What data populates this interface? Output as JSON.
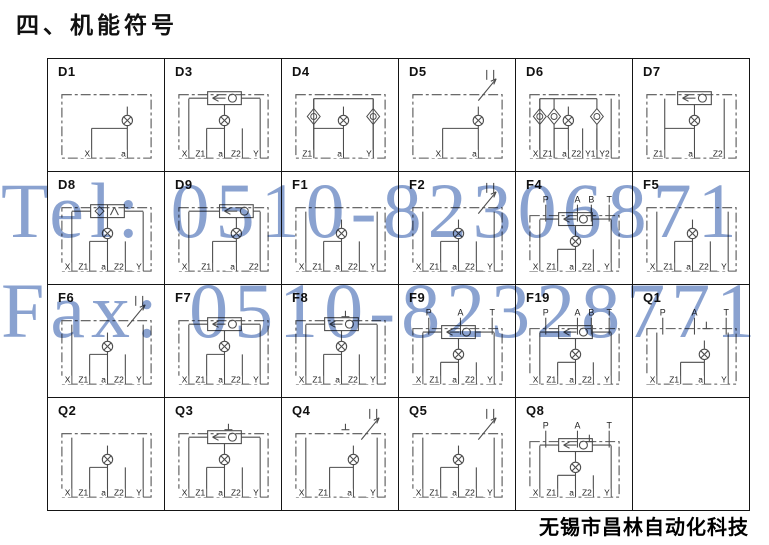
{
  "page": {
    "title": "四、机能符号",
    "company": "无锡市昌林自动化科技"
  },
  "watermark": {
    "line1": "Tel: 0510-82306871",
    "line2": "Fax: 0510-82328771",
    "color": "#8aa2d0"
  },
  "colors": {
    "grid_border": "#151515",
    "schematic_line": "#4d4d4d",
    "label_text": "#222222"
  },
  "table": {
    "columns": 6,
    "rows": 4,
    "cells": [
      {
        "id": "D1",
        "ports": [
          "X",
          "a"
        ],
        "top_ports": [],
        "features": [
          "orifice"
        ]
      },
      {
        "id": "D3",
        "ports": [
          "X",
          "Z1",
          "a",
          "Z2",
          "Y"
        ],
        "top_ports": [],
        "features": [
          "shuttle",
          "orifice"
        ]
      },
      {
        "id": "D4",
        "ports": [
          "Z1",
          "a",
          "Y"
        ],
        "top_ports": [],
        "features": [
          "check2",
          "orifice"
        ]
      },
      {
        "id": "D5",
        "ports": [
          "X",
          "a"
        ],
        "top_ports": [],
        "features": [
          "orifice",
          "throttle"
        ]
      },
      {
        "id": "D6",
        "ports": [
          "X",
          "Z1",
          "a",
          "Z2",
          "Y1",
          "Y2"
        ],
        "top_ports": [],
        "features": [
          "check3",
          "orifice"
        ]
      },
      {
        "id": "D7",
        "ports": [
          "Z1",
          "a",
          "Z2"
        ],
        "top_ports": [],
        "features": [
          "shuttle",
          "orifice"
        ]
      },
      {
        "id": "D8",
        "ports": [
          "X",
          "Z1",
          "a",
          "Z2",
          "Y"
        ],
        "top_ports": [],
        "features": [
          "valve2",
          "orifice"
        ]
      },
      {
        "id": "D9",
        "ports": [
          "X",
          "Z1",
          "a",
          "Z2"
        ],
        "top_ports": [],
        "features": [
          "shuttle",
          "orifice"
        ]
      },
      {
        "id": "F1",
        "ports": [
          "X",
          "Z1",
          "a",
          "Z2",
          "Y"
        ],
        "top_ports": [],
        "features": [
          "orifice"
        ]
      },
      {
        "id": "F2",
        "ports": [
          "X",
          "Z1",
          "a",
          "Z2",
          "Y"
        ],
        "top_ports": [],
        "features": [
          "orifice",
          "throttle"
        ]
      },
      {
        "id": "F4",
        "ports": [
          "X",
          "Z1",
          "a",
          "Z2",
          "Y"
        ],
        "top_ports": [
          "P",
          "A",
          "B",
          "T"
        ],
        "features": [
          "shuttle",
          "orifice",
          "plug"
        ]
      },
      {
        "id": "F5",
        "ports": [
          "X",
          "Z1",
          "a",
          "Z2",
          "Y"
        ],
        "top_ports": [],
        "features": [
          "orifice"
        ]
      },
      {
        "id": "F6",
        "ports": [
          "X",
          "Z1",
          "a",
          "Z2",
          "Y"
        ],
        "top_ports": [],
        "features": [
          "orifice",
          "throttle"
        ]
      },
      {
        "id": "F7",
        "ports": [
          "X",
          "Z1",
          "a",
          "Z2",
          "Y"
        ],
        "top_ports": [],
        "features": [
          "shuttle",
          "orifice"
        ]
      },
      {
        "id": "F8",
        "ports": [
          "X",
          "Z1",
          "a",
          "Z2",
          "Y"
        ],
        "top_ports": [],
        "features": [
          "shuttle",
          "orifice",
          "plug"
        ]
      },
      {
        "id": "F9",
        "ports": [
          "X",
          "Z1",
          "a",
          "Z2",
          "Y"
        ],
        "top_ports": [
          "P",
          "A",
          "T"
        ],
        "features": [
          "shuttle",
          "orifice"
        ]
      },
      {
        "id": "F19",
        "ports": [
          "X",
          "Z1",
          "a",
          "Z2",
          "Y"
        ],
        "top_ports": [
          "P",
          "A",
          "B",
          "T"
        ],
        "features": [
          "shuttle",
          "orifice"
        ]
      },
      {
        "id": "Q1",
        "ports": [
          "X",
          "Z1",
          "a",
          "Y"
        ],
        "top_ports": [
          "P",
          "A",
          "T"
        ],
        "features": [
          "orifice",
          "plug"
        ]
      },
      {
        "id": "Q2",
        "ports": [
          "X",
          "Z1",
          "a",
          "Z2",
          "Y"
        ],
        "top_ports": [],
        "features": [
          "orifice"
        ]
      },
      {
        "id": "Q3",
        "ports": [
          "X",
          "Z1",
          "a",
          "Z2",
          "Y"
        ],
        "top_ports": [],
        "features": [
          "shuttle",
          "orifice",
          "plug"
        ]
      },
      {
        "id": "Q4",
        "ports": [
          "X",
          "Z1",
          "a",
          "Y"
        ],
        "top_ports": [],
        "features": [
          "orifice",
          "throttle",
          "plug"
        ]
      },
      {
        "id": "Q5",
        "ports": [
          "X",
          "Z1",
          "a",
          "Z2",
          "Y"
        ],
        "top_ports": [],
        "features": [
          "orifice",
          "throttle"
        ]
      },
      {
        "id": "Q8",
        "ports": [
          "X",
          "Z1",
          "a",
          "Z2",
          "Y"
        ],
        "top_ports": [
          "P",
          "A",
          "T"
        ],
        "features": [
          "shuttle",
          "orifice",
          "plug"
        ]
      },
      {
        "id": "",
        "ports": [],
        "top_ports": [],
        "features": []
      }
    ]
  }
}
